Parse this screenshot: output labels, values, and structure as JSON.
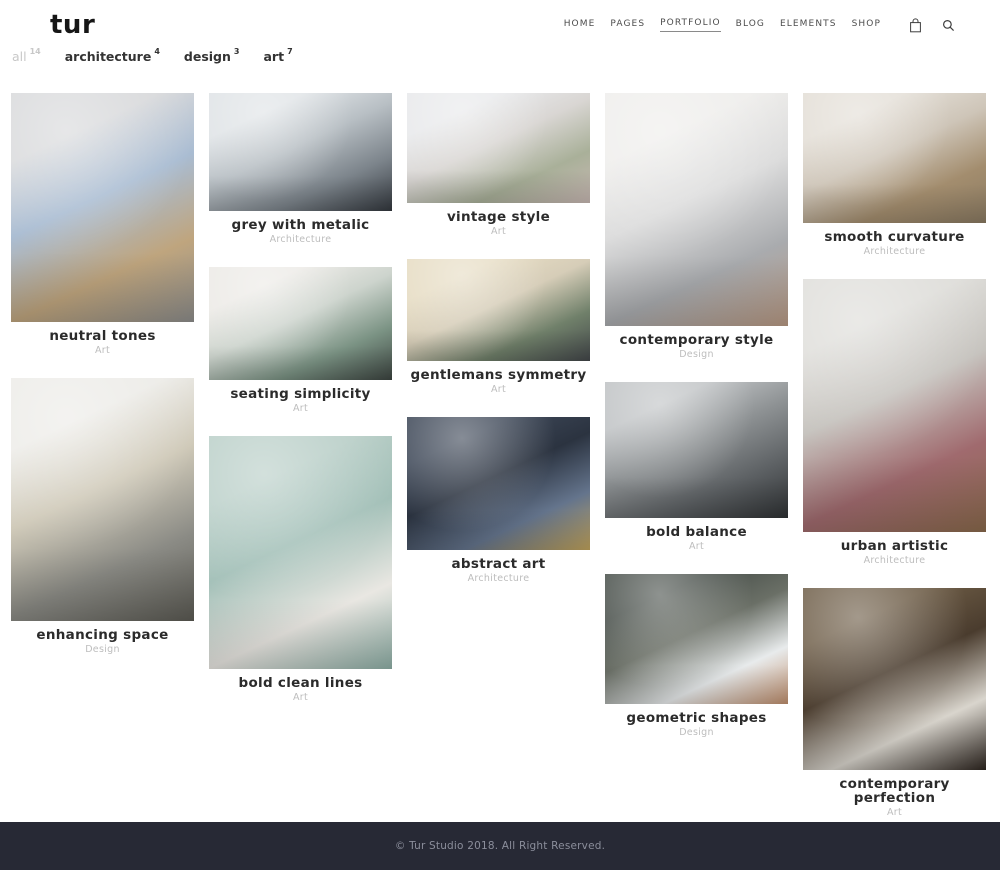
{
  "header": {
    "logo": "tur",
    "nav": [
      {
        "label": "HOME",
        "active": false
      },
      {
        "label": "PAGES",
        "active": false
      },
      {
        "label": "PORTFOLIO",
        "active": true
      },
      {
        "label": "BLOG",
        "active": false
      },
      {
        "label": "ELEMENTS",
        "active": false
      },
      {
        "label": "SHOP",
        "active": false
      }
    ],
    "icons": [
      {
        "name": "cart-icon"
      },
      {
        "name": "search-icon"
      }
    ]
  },
  "filters": [
    {
      "label": "all",
      "count": "14",
      "muted": true
    },
    {
      "label": "architecture",
      "count": "4",
      "muted": false
    },
    {
      "label": "design",
      "count": "3",
      "muted": false
    },
    {
      "label": "art",
      "count": "7",
      "muted": false
    }
  ],
  "portfolio": {
    "columns": [
      [
        {
          "title": "neutral tones",
          "category": "Art",
          "h": 229,
          "palette": [
            "#d7d8da",
            "#a9bcd2",
            "#bfa57e",
            "#8e8e8c"
          ]
        },
        {
          "title": "enhancing space",
          "category": "Design",
          "h": 243,
          "palette": [
            "#ecebe7",
            "#cfc9b8",
            "#8b8b85",
            "#5c5b54"
          ]
        }
      ],
      [
        {
          "title": "grey with metalic",
          "category": "Architecture",
          "h": 118,
          "palette": [
            "#dfe3e6",
            "#b8bfc4",
            "#7c848b",
            "#33383e"
          ]
        },
        {
          "title": "seating simplicity",
          "category": "Art",
          "h": 113,
          "palette": [
            "#eceae6",
            "#cdd4cd",
            "#7b9384",
            "#3c4440"
          ]
        },
        {
          "title": "bold clean lines",
          "category": "Art",
          "h": 233,
          "palette": [
            "#b7cdc6",
            "#a3c0b8",
            "#e9e7e2",
            "#8fb0a7"
          ]
        }
      ],
      [
        {
          "title": "vintage style",
          "category": "Art",
          "h": 110,
          "palette": [
            "#e8e9eb",
            "#d9d6d3",
            "#a9b099",
            "#c9b9b4"
          ]
        },
        {
          "title": "gentlemans symmetry",
          "category": "Art",
          "h": 102,
          "palette": [
            "#e6dcc3",
            "#d6cdb8",
            "#70806a",
            "#43474a"
          ]
        },
        {
          "title": "abstract art",
          "category": "Architecture",
          "h": 133,
          "palette": [
            "#3c4656",
            "#2b3340",
            "#64748c",
            "#c2a45c"
          ]
        }
      ],
      [
        {
          "title": "contemporary style",
          "category": "Design",
          "h": 233,
          "palette": [
            "#eeedeb",
            "#dcdcdc",
            "#a9abae",
            "#b99a84"
          ]
        },
        {
          "title": "bold balance",
          "category": "Art",
          "h": 136,
          "palette": [
            "#bfc2c4",
            "#8e9294",
            "#5d6164",
            "#2f3234"
          ]
        },
        {
          "title": "geometric shapes",
          "category": "Design",
          "h": 130,
          "palette": [
            "#49504b",
            "#6a6f66",
            "#e8ebec",
            "#c08f6d"
          ]
        }
      ],
      [
        {
          "title": "smooth curvature",
          "category": "Architecture",
          "h": 130,
          "palette": [
            "#e3ded6",
            "#cec5b8",
            "#a38d6e",
            "#8a7a62"
          ]
        },
        {
          "title": "urban artistic",
          "category": "Architecture",
          "h": 253,
          "palette": [
            "#dddcd8",
            "#c5c2bd",
            "#a06a6e",
            "#8a6a4c"
          ]
        },
        {
          "title": "contemporary perfection",
          "category": "Art",
          "h": 182,
          "palette": [
            "#6b5a44",
            "#4a3c2e",
            "#d9d5cd",
            "#2e2620"
          ]
        }
      ]
    ]
  },
  "footer": {
    "copyright": "© Tur Studio 2018. All Right Reserved."
  },
  "colors": {
    "footer_bg": "#272935",
    "footer_text": "#8b8e9b",
    "title": "#2b2b2b",
    "category": "#bdbdbd",
    "muted_filter": "#c8c8c8"
  }
}
